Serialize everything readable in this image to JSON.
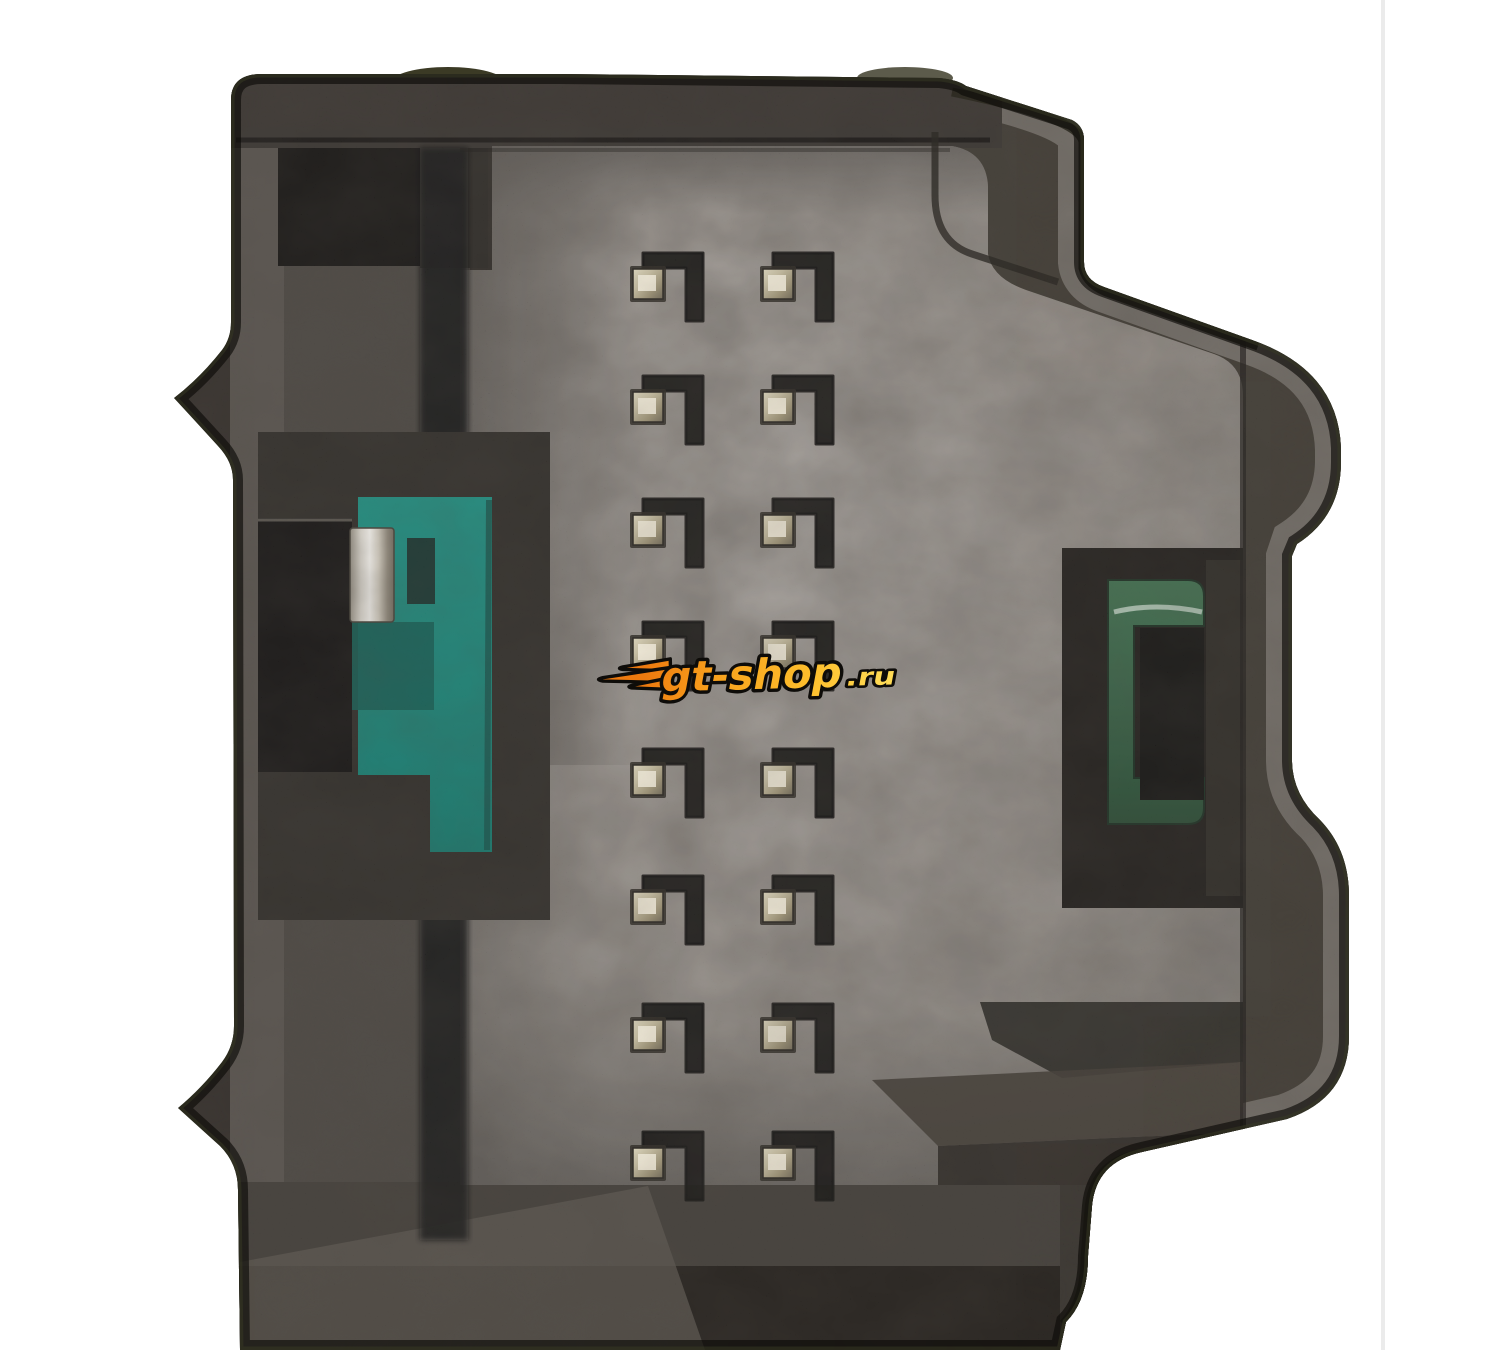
{
  "meta": {
    "type": "product-photograph",
    "subject": "Macro close-up of a black plastic multi-pin automotive electrical connector socket, face-on view, on a white studio background"
  },
  "watermark": {
    "main": "gt-shop",
    "suffix": ".ru"
  },
  "connector": {
    "pin_grid": {
      "rows": 8,
      "cols": 2,
      "total_pins": 16,
      "cols_x": [
        633,
        763
      ],
      "rows_y": [
        269,
        392,
        515,
        638,
        765,
        892,
        1020,
        1148
      ],
      "pin_size": 30
    },
    "inserts": {
      "left": "teal keying insert with silver terminal",
      "right": "dark-green bracket insert"
    }
  },
  "colors": {
    "background": "#ffffff",
    "housing_dark": "#26221e",
    "housing_wall": "#403c37",
    "cap": "#2e2a26",
    "face_light": "#938e89",
    "face_dark": "#5b5650",
    "teal_top": "#11897b",
    "teal_bottom": "#0b6e62",
    "green_top": "#356846",
    "green_bottom": "#1e4129",
    "silver_terminal": "#f4f2ed",
    "metal_pin_bright": "#f3edda",
    "metal_pin_base": "#c4bb9d",
    "logo_orange": "#ed7a0f",
    "logo_mid": "#f9a51e",
    "logo_yellow": "#ffdb55",
    "logo_outline": "#0e0c09"
  }
}
